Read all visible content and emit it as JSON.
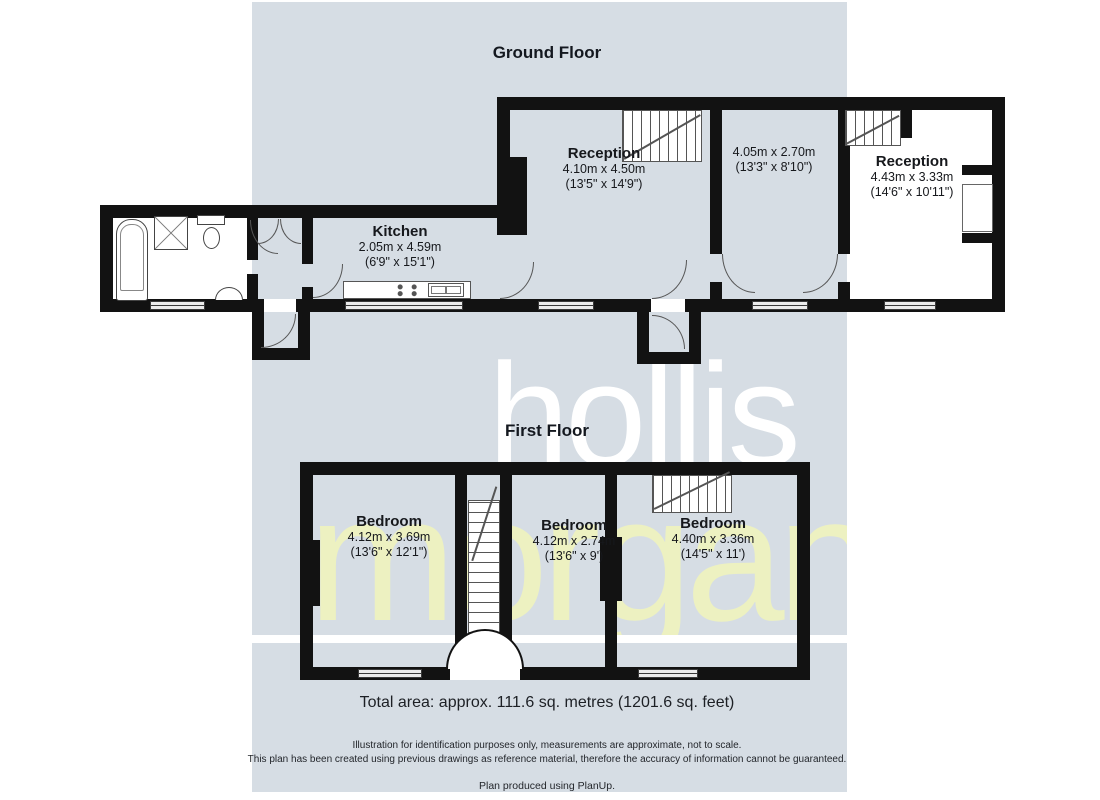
{
  "colors": {
    "panel_blue": "#d6dde4",
    "wall_black": "#121212",
    "watermark_white": "#ffffff",
    "watermark_yellow": "#edf1c1"
  },
  "watermark": {
    "line1": "hollis",
    "line2": "morgan"
  },
  "ground_floor": {
    "title": "Ground Floor",
    "rooms": [
      {
        "name": "Reception",
        "metric": "4.10m x 4.50m",
        "imperial": "(13'5\" x 14'9\")"
      },
      {
        "name": "",
        "metric": "4.05m x 2.70m",
        "imperial": "(13'3\" x 8'10\")"
      },
      {
        "name": "Reception",
        "metric": "4.43m x 3.33m",
        "imperial": "(14'6\" x 10'11\")"
      },
      {
        "name": "Kitchen",
        "metric": "2.05m x 4.59m",
        "imperial": "(6'9\" x 15'1\")"
      }
    ]
  },
  "first_floor": {
    "title": "First Floor",
    "rooms": [
      {
        "name": "Bedroom",
        "metric": "4.12m x 3.69m",
        "imperial": "(13'6\" x 12'1\")"
      },
      {
        "name": "Bedroom",
        "metric": "4.12m x 2.74m",
        "imperial": "(13'6\" x 9')"
      },
      {
        "name": "Bedroom",
        "metric": "4.40m x 3.36m",
        "imperial": "(14'5\" x 11')"
      }
    ]
  },
  "footer": {
    "total_area": "Total area: approx. 111.6 sq. metres (1201.6 sq. feet)",
    "disclaimer_line1": "Illustration for identification purposes only, measurements are approximate, not to scale.",
    "disclaimer_line2": "This plan has been created using previous drawings as reference material, therefore the accuracy of information cannot be guaranteed.",
    "credit": "Plan produced using PlanUp."
  }
}
